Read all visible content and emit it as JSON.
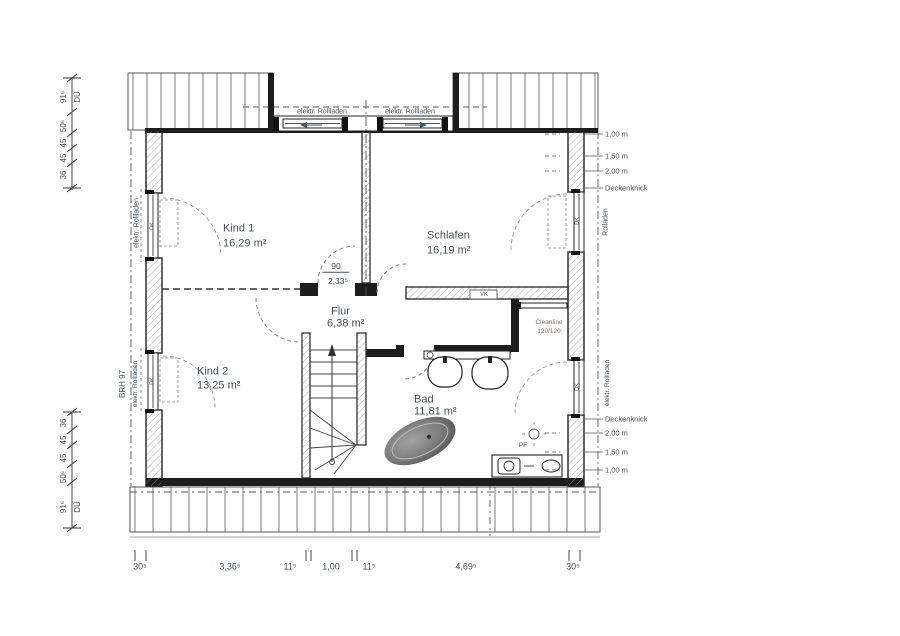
{
  "document": {
    "type": "floor-plan-attic-storey"
  },
  "rooms": [
    {
      "name": "Kind 1",
      "area": "16,29 m²"
    },
    {
      "name": "Schlafen",
      "area": "16,19 m²"
    },
    {
      "name": "Flur",
      "area": "6,38 m²"
    },
    {
      "name": "Kind 2",
      "area": "13,25 m²"
    },
    {
      "name": "Bad",
      "area": "11,81 m²"
    }
  ],
  "opening": {
    "width": "90",
    "height": "2,33⁵"
  },
  "shower": {
    "line1": "Cleanline",
    "line2": "120/120"
  },
  "marks": {
    "vk": "VK",
    "pf": "PF",
    "dk": "DK",
    "du": "DÜ",
    "brh": "BRH 97"
  },
  "window_labels": {
    "dormer_left": "elektr. Rollladen",
    "dormer_right": "elektr. Rollladen",
    "left_top": "elektr. Rollladen",
    "left_bottom": "elektr. Rollladen",
    "right_top": "Rolladen",
    "right_bottom": "elektr. Rollladen"
  },
  "heights_top": [
    "1,00 m",
    "1,50 m",
    "2,00 m",
    "Deckenknick"
  ],
  "heights_bottom": [
    "Deckenknick",
    "2,00 m",
    "1,50 m",
    "1,00 m"
  ],
  "dims": {
    "left_top": [
      "91⁶",
      "50⁶",
      "45",
      "45",
      "36"
    ],
    "left_bottom": [
      "36",
      "45",
      "45",
      "50⁶",
      "91⁶"
    ],
    "bottom": [
      "30⁵",
      "3,36⁵",
      "11⁵",
      "1,00",
      "11⁵",
      "4,69⁵",
      "30⁵"
    ]
  },
  "colors": {
    "wall": "#1d1d1d",
    "line": "#2b2b2b",
    "text": "#43505a",
    "hatch": "#9a9a9a",
    "dash": "#5a5a5a"
  }
}
